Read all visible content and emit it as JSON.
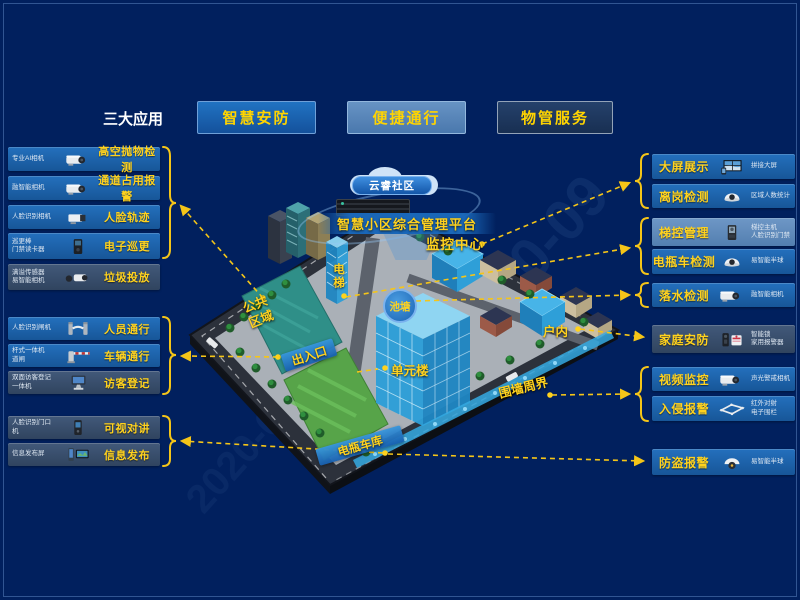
{
  "watermark": {
    "text": "2020-09"
  },
  "header": {
    "title": "三大应用",
    "buttons": [
      {
        "label": "智慧安防"
      },
      {
        "label": "便捷通行"
      },
      {
        "label": "物管服务"
      }
    ]
  },
  "left": {
    "group1": {
      "rows": [
        {
          "device": "专业AI相机",
          "feature": "高空抛物检测",
          "icon": "bullet-camera"
        },
        {
          "device": "融智能相机",
          "feature": "通道占用报警",
          "icon": "bullet-camera"
        },
        {
          "device": "人脸识别相机",
          "feature": "人脸轨迹",
          "icon": "box-camera"
        },
        {
          "device": "巡更棒\n门禁读卡器",
          "feature": "电子巡更",
          "icon": "card-reader"
        },
        {
          "device": "满溢传感器\n易智能相机",
          "feature": "垃圾投放",
          "icon": "sensor-camera"
        }
      ]
    },
    "group2": {
      "rows": [
        {
          "device": "人脸识别闸机",
          "feature": "人员通行",
          "icon": "turnstile"
        },
        {
          "device": "杆式一体机\n道闸",
          "feature": "车辆通行",
          "icon": "barrier-gate"
        },
        {
          "device": "双面访客登记\n一体机",
          "feature": "访客登记",
          "icon": "visitor-kiosk"
        }
      ]
    },
    "group3": {
      "rows": [
        {
          "device": "人脸识别门口\n机",
          "feature": "可视对讲",
          "icon": "door-phone"
        },
        {
          "device": "信息发布屏",
          "feature": "信息发布",
          "icon": "signage-screen"
        }
      ]
    }
  },
  "right": {
    "rows": [
      {
        "feature": "大屏展示",
        "device": "拼接大屏",
        "icon": "video-wall"
      },
      {
        "feature": "离岗检测",
        "device": "区域人数统计",
        "icon": "dome-camera"
      },
      {
        "feature": "梯控管理",
        "device": "梯控主机\n人脸识别门禁",
        "icon": "access-terminal"
      },
      {
        "feature": "电瓶车检测",
        "device": "易智能半球",
        "icon": "dome-camera"
      },
      {
        "feature": "落水检测",
        "device": "融智能相机",
        "icon": "bullet-camera"
      },
      {
        "feature": "家庭安防",
        "device": "智能锁\n家用报警器",
        "icon": "lock-alarm"
      },
      {
        "feature": "视频监控",
        "device": "声光警戒相机",
        "icon": "bullet-camera"
      },
      {
        "feature": "入侵报警",
        "device": "红外对射\n电子围栏",
        "icon": "fence"
      },
      {
        "feature": "防盗报警",
        "device": "易智能半球",
        "icon": "dome-camera-active"
      }
    ]
  },
  "map": {
    "cloud_label": "云睿社区",
    "platform_label": "智慧小区综合管理平台",
    "labels": {
      "monitor_center": "监控中心",
      "elevator": "电梯",
      "pond": "池塘",
      "public_area": "公共\n区域",
      "entrance": "出入口",
      "unit_building": "单元楼",
      "indoor": "户内",
      "perimeter": "围墙周界",
      "bike_garage": "电瓶车库"
    }
  },
  "colors": {
    "accent_yellow": "#ffd21e",
    "row_blue": "#1e62ab",
    "row_light": "#5d8ec5",
    "row_dark": "#36506f",
    "background": "#01205e"
  }
}
